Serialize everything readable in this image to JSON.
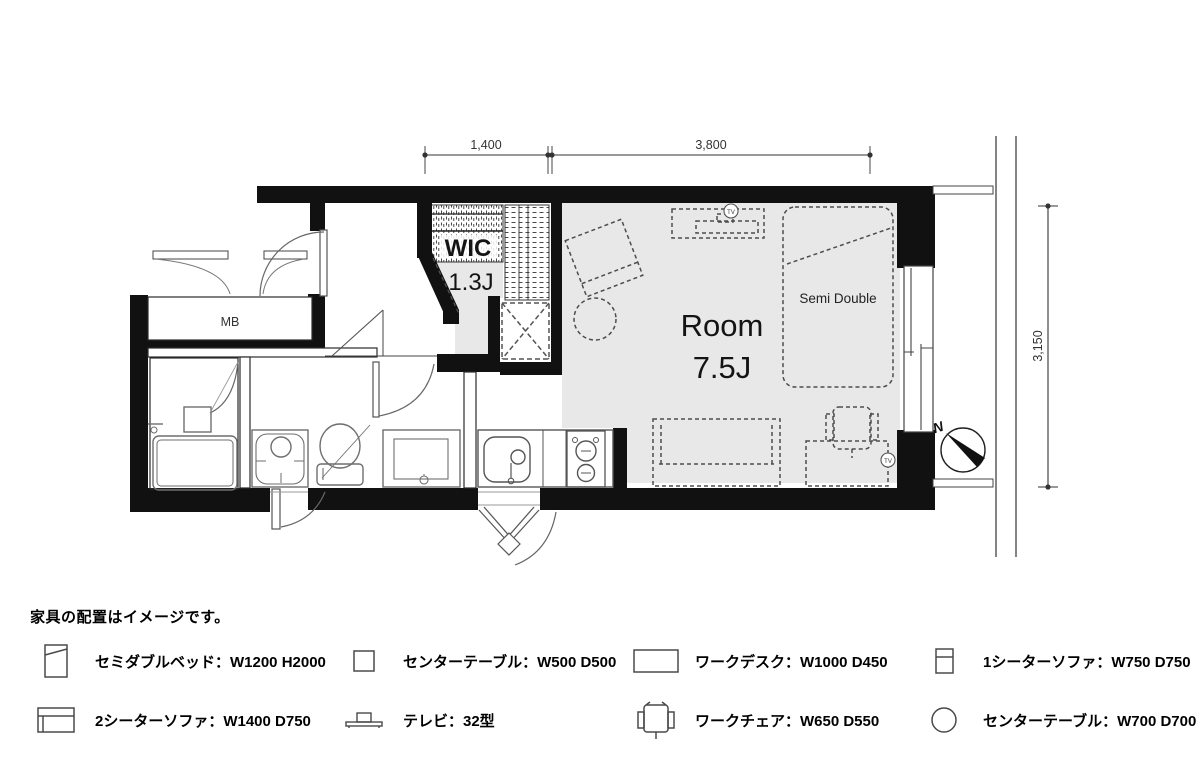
{
  "plan": {
    "dimensions": {
      "width_entry": "1,400",
      "width_room": "3,800",
      "depth_room": "3,150"
    },
    "labels": {
      "wic": "WIC",
      "wic_size": "1.3J",
      "room": "Room",
      "room_size": "7.5J",
      "bed": "Semi Double",
      "meter_box": "MB",
      "tv_outlet": "TV",
      "north": "N"
    }
  },
  "legend": {
    "note": "家具の配置はイメージです。",
    "items": [
      {
        "id": "semi-double-bed",
        "label": "セミダブルベッド：W1200 H2000"
      },
      {
        "id": "center-table-small",
        "label": "センターテーブル：W500 D500"
      },
      {
        "id": "work-desk",
        "label": "ワークデスク：W1000 D450"
      },
      {
        "id": "one-seater-sofa",
        "label": "1シーターソファ：W750 D750"
      },
      {
        "id": "two-seater-sofa",
        "label": "2シーターソファ：W1400 D750"
      },
      {
        "id": "tv",
        "label": "テレビ：32型"
      },
      {
        "id": "work-chair",
        "label": "ワークチェア：W650 D550"
      },
      {
        "id": "center-table-round",
        "label": "センターテーブル：W700 D700"
      }
    ]
  },
  "colors": {
    "wall": "#111111",
    "floor": "#e8e8e8",
    "furniture_line": "#4d4d4d",
    "fixture_line": "#6e6e6e"
  }
}
